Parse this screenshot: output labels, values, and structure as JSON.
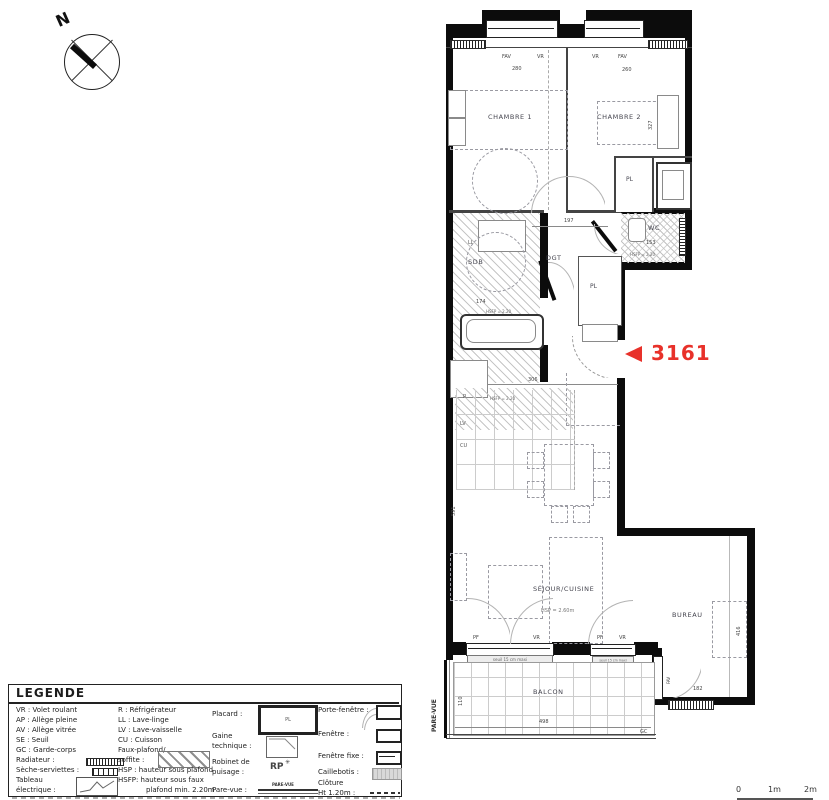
{
  "compass": {
    "north": "N"
  },
  "marker": {
    "arrow": "◄",
    "number": "3161",
    "color": "#e8312a"
  },
  "plan": {
    "rooms": {
      "chambre1": "CHAMBRE 1",
      "chambre2": "CHAMBRE 2",
      "wc": "WC",
      "sdb": "SDB",
      "dgt": "DGT",
      "pl": "PL",
      "sejour": "SÉJOUR/CUISINE",
      "sejour_hsp": "HSP = 2.60m",
      "bureau": "BUREAU",
      "balcon": "BALCON"
    },
    "tags": {
      "fav": "FAV",
      "vr": "VR",
      "pf": "PF",
      "r": "R",
      "ll": "LL",
      "lv": "LV",
      "cu": "CU",
      "gc": "GC",
      "hsfp": "HSFP = 2.20",
      "seuil": "seuil 15 cm maxi",
      "parevue": "PARE-VUE"
    },
    "dims": {
      "win1": "280",
      "win2": "260",
      "ch1_h": "415",
      "ch2_h": "327",
      "hall": "197",
      "wc": "153",
      "sdb": "174",
      "kitchen": "306",
      "sejour_h": "591",
      "balcon_w": "498",
      "balcon_h": "110",
      "bureau": "182",
      "bureau_h": "416"
    }
  },
  "legend": {
    "title": "LEGENDE",
    "col1": [
      "VR : Volet roulant",
      "AP : Allège pleine",
      "AV : Allège vitrée",
      "SE : Seuil",
      "GC : Garde-corps",
      "Radiateur :",
      "Sèche-serviettes :",
      "Tableau",
      "électrique :"
    ],
    "col2": [
      "R : Réfrigérateur",
      "LL : Lave-linge",
      "LV : Lave-vaisselle",
      "CU : Cuisson",
      "Faux-plafond/",
      "soffite :",
      "HSP : hauteur sous plafond",
      "HSFP: hauteur sous faux",
      "plafond min. 2.20m"
    ],
    "col3": [
      "Placard :",
      "Gaine",
      "technique :",
      "Robinet de",
      "puisage :",
      "RP",
      "Pare-vue :"
    ],
    "col4": [
      "Porte-fenêtre :",
      "Fenêtre :",
      "Fenêtre fixe :",
      "Caillebotis :",
      "Clôture",
      "Ht 1.20m :"
    ],
    "placard_pl": "PL"
  },
  "scale": {
    "t0": "0",
    "t1": "1m",
    "t2": "2m"
  }
}
